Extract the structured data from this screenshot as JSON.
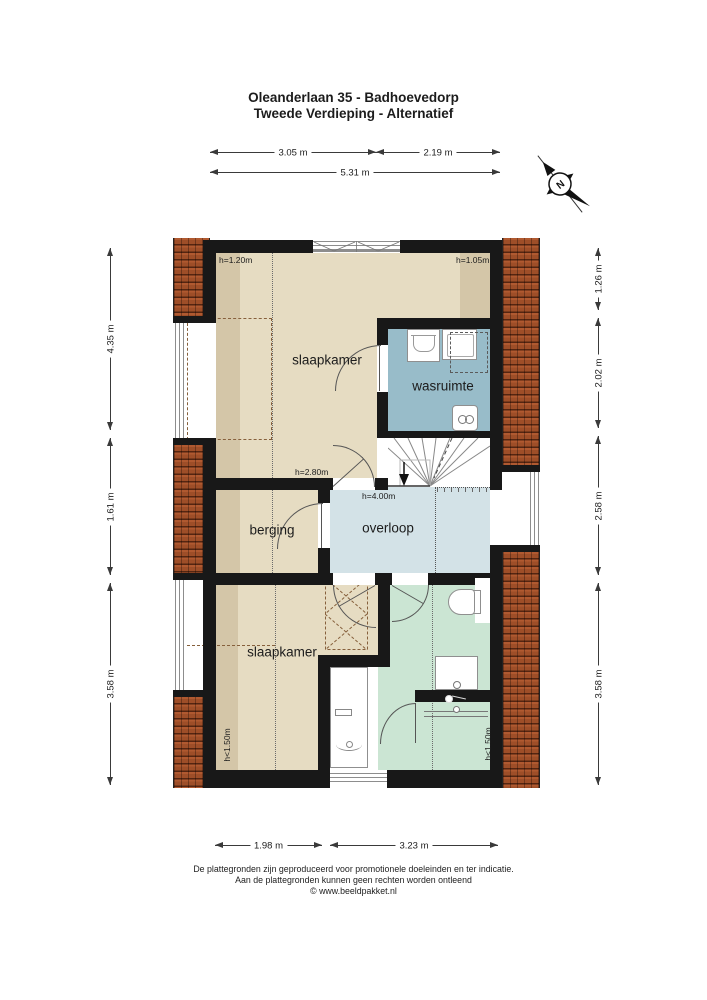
{
  "title": {
    "line1": "Oleanderlaan 35 - Badhoevedorp",
    "line2": "Tweede Verdieping - Alternatief"
  },
  "compass": {
    "label": "N"
  },
  "dims": {
    "top": [
      {
        "label": "3.05 m"
      },
      {
        "label": "2.19 m"
      },
      {
        "label": "5.31 m"
      }
    ],
    "left": [
      {
        "label": "4.35 m"
      },
      {
        "label": "1.61 m"
      },
      {
        "label": "3.58 m"
      }
    ],
    "right": [
      {
        "label": "1.26 m"
      },
      {
        "label": "2.02 m"
      },
      {
        "label": "2.58 m"
      },
      {
        "label": "3.58 m"
      }
    ],
    "bottom": [
      {
        "label": "1.98 m"
      },
      {
        "label": "3.23 m"
      }
    ]
  },
  "rooms": [
    {
      "id": "slaapkamer-top",
      "label": "slaapkamer"
    },
    {
      "id": "wasruimte",
      "label": "wasruimte"
    },
    {
      "id": "berging",
      "label": "berging"
    },
    {
      "id": "overloop",
      "label": "overloop"
    },
    {
      "id": "slaapkamer-bottom",
      "label": "slaapkamer"
    }
  ],
  "heights": [
    {
      "id": "top-left",
      "label": "h=1.20m"
    },
    {
      "id": "top-right",
      "label": "h=1.05m"
    },
    {
      "id": "mid-door",
      "label": "h=2.80m"
    },
    {
      "id": "overloop",
      "label": "h=4.00m"
    },
    {
      "id": "bottom-left",
      "label": "h<1.50m"
    },
    {
      "id": "bottom-right",
      "label": "h<1.50m"
    }
  ],
  "footer": {
    "line1": "De plattegronden zijn geproduceerd voor promotionele doeleinden en ter indicatie.",
    "line2": "Aan de plattegronden kunnen geen rechten worden ontleend",
    "line3": "© www.beeldpakket.nl"
  },
  "colors": {
    "room_beige": "#e6dcc2",
    "wasruimte_blue": "#98bcc9",
    "overloop_blue": "#d3e2e7",
    "bathroom_green": "#cbe5d3",
    "roof_tile": "#9e4e28",
    "wall": "#181818"
  }
}
